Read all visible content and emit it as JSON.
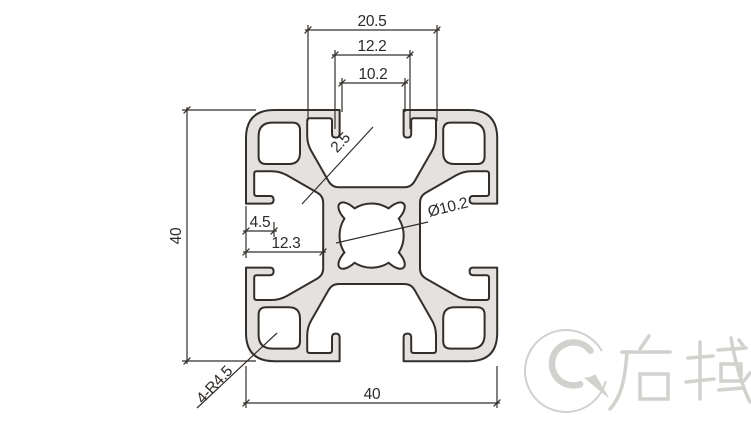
{
  "drawing": {
    "dims": {
      "slot_chamber_width": "20.5",
      "slot_lip_width": "12.2",
      "slot_opening_width": "10.2",
      "overall_height": "40",
      "overall_width": "40",
      "slot_depth": "4.5",
      "cavity_depth": "12.3",
      "wall_thickness": "2.5",
      "center_bore": "Ø10.2",
      "corner_radius": "4-R4.5"
    },
    "watermark": {
      "text": "启域"
    }
  },
  "colors": {
    "line": "#332e2a",
    "profile_fill": "#e3e2e0",
    "watermark": "#d3d1ce"
  }
}
